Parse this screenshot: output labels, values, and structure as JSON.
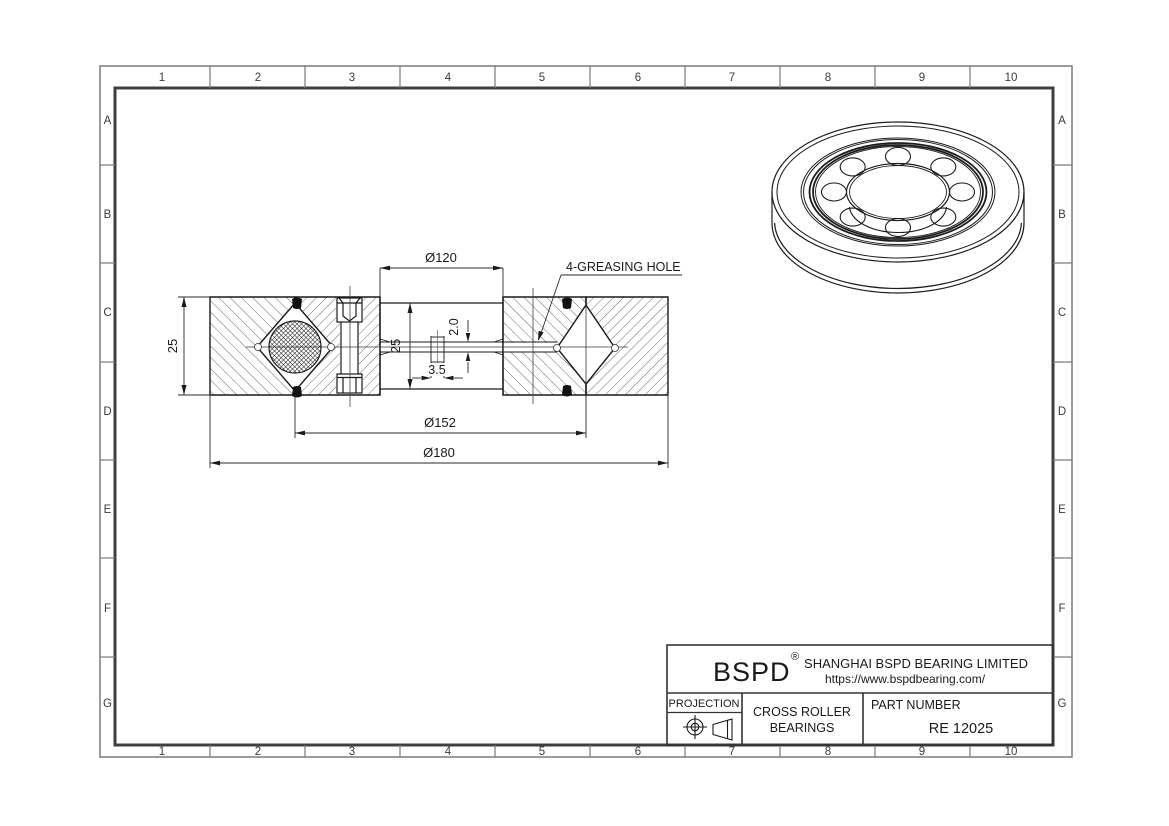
{
  "frame": {
    "columns": [
      "1",
      "2",
      "3",
      "4",
      "5",
      "6",
      "7",
      "8",
      "9",
      "10"
    ],
    "rows": [
      "A",
      "B",
      "C",
      "D",
      "E",
      "F",
      "G"
    ]
  },
  "drawing": {
    "dimensions": {
      "bore_dia": "Ø120",
      "pitch_dia": "Ø152",
      "outer_dia": "Ø180",
      "section_height": "25",
      "inner_height": "25",
      "grease_hole_width": "3.5",
      "grease_hole_height": "2.0",
      "grease_note": "4-GREASING HOLE"
    }
  },
  "title_block": {
    "brand": "BSPD",
    "registered": "®",
    "company": "SHANGHAI BSPD BEARING LIMITED",
    "website": "https://www.bspdbearing.com/",
    "projection_label": "PROJECTION",
    "product_line1": "CROSS ROLLER",
    "product_line2": "BEARINGS",
    "part_number_label": "PART  NUMBER",
    "part_number": "RE 12025"
  },
  "colors": {
    "line": "#1a1a1a",
    "thin_line": "#333333",
    "frame_outer": "#7a7a7a",
    "frame_inner": "#3f3f3f",
    "background": "#ffffff"
  }
}
